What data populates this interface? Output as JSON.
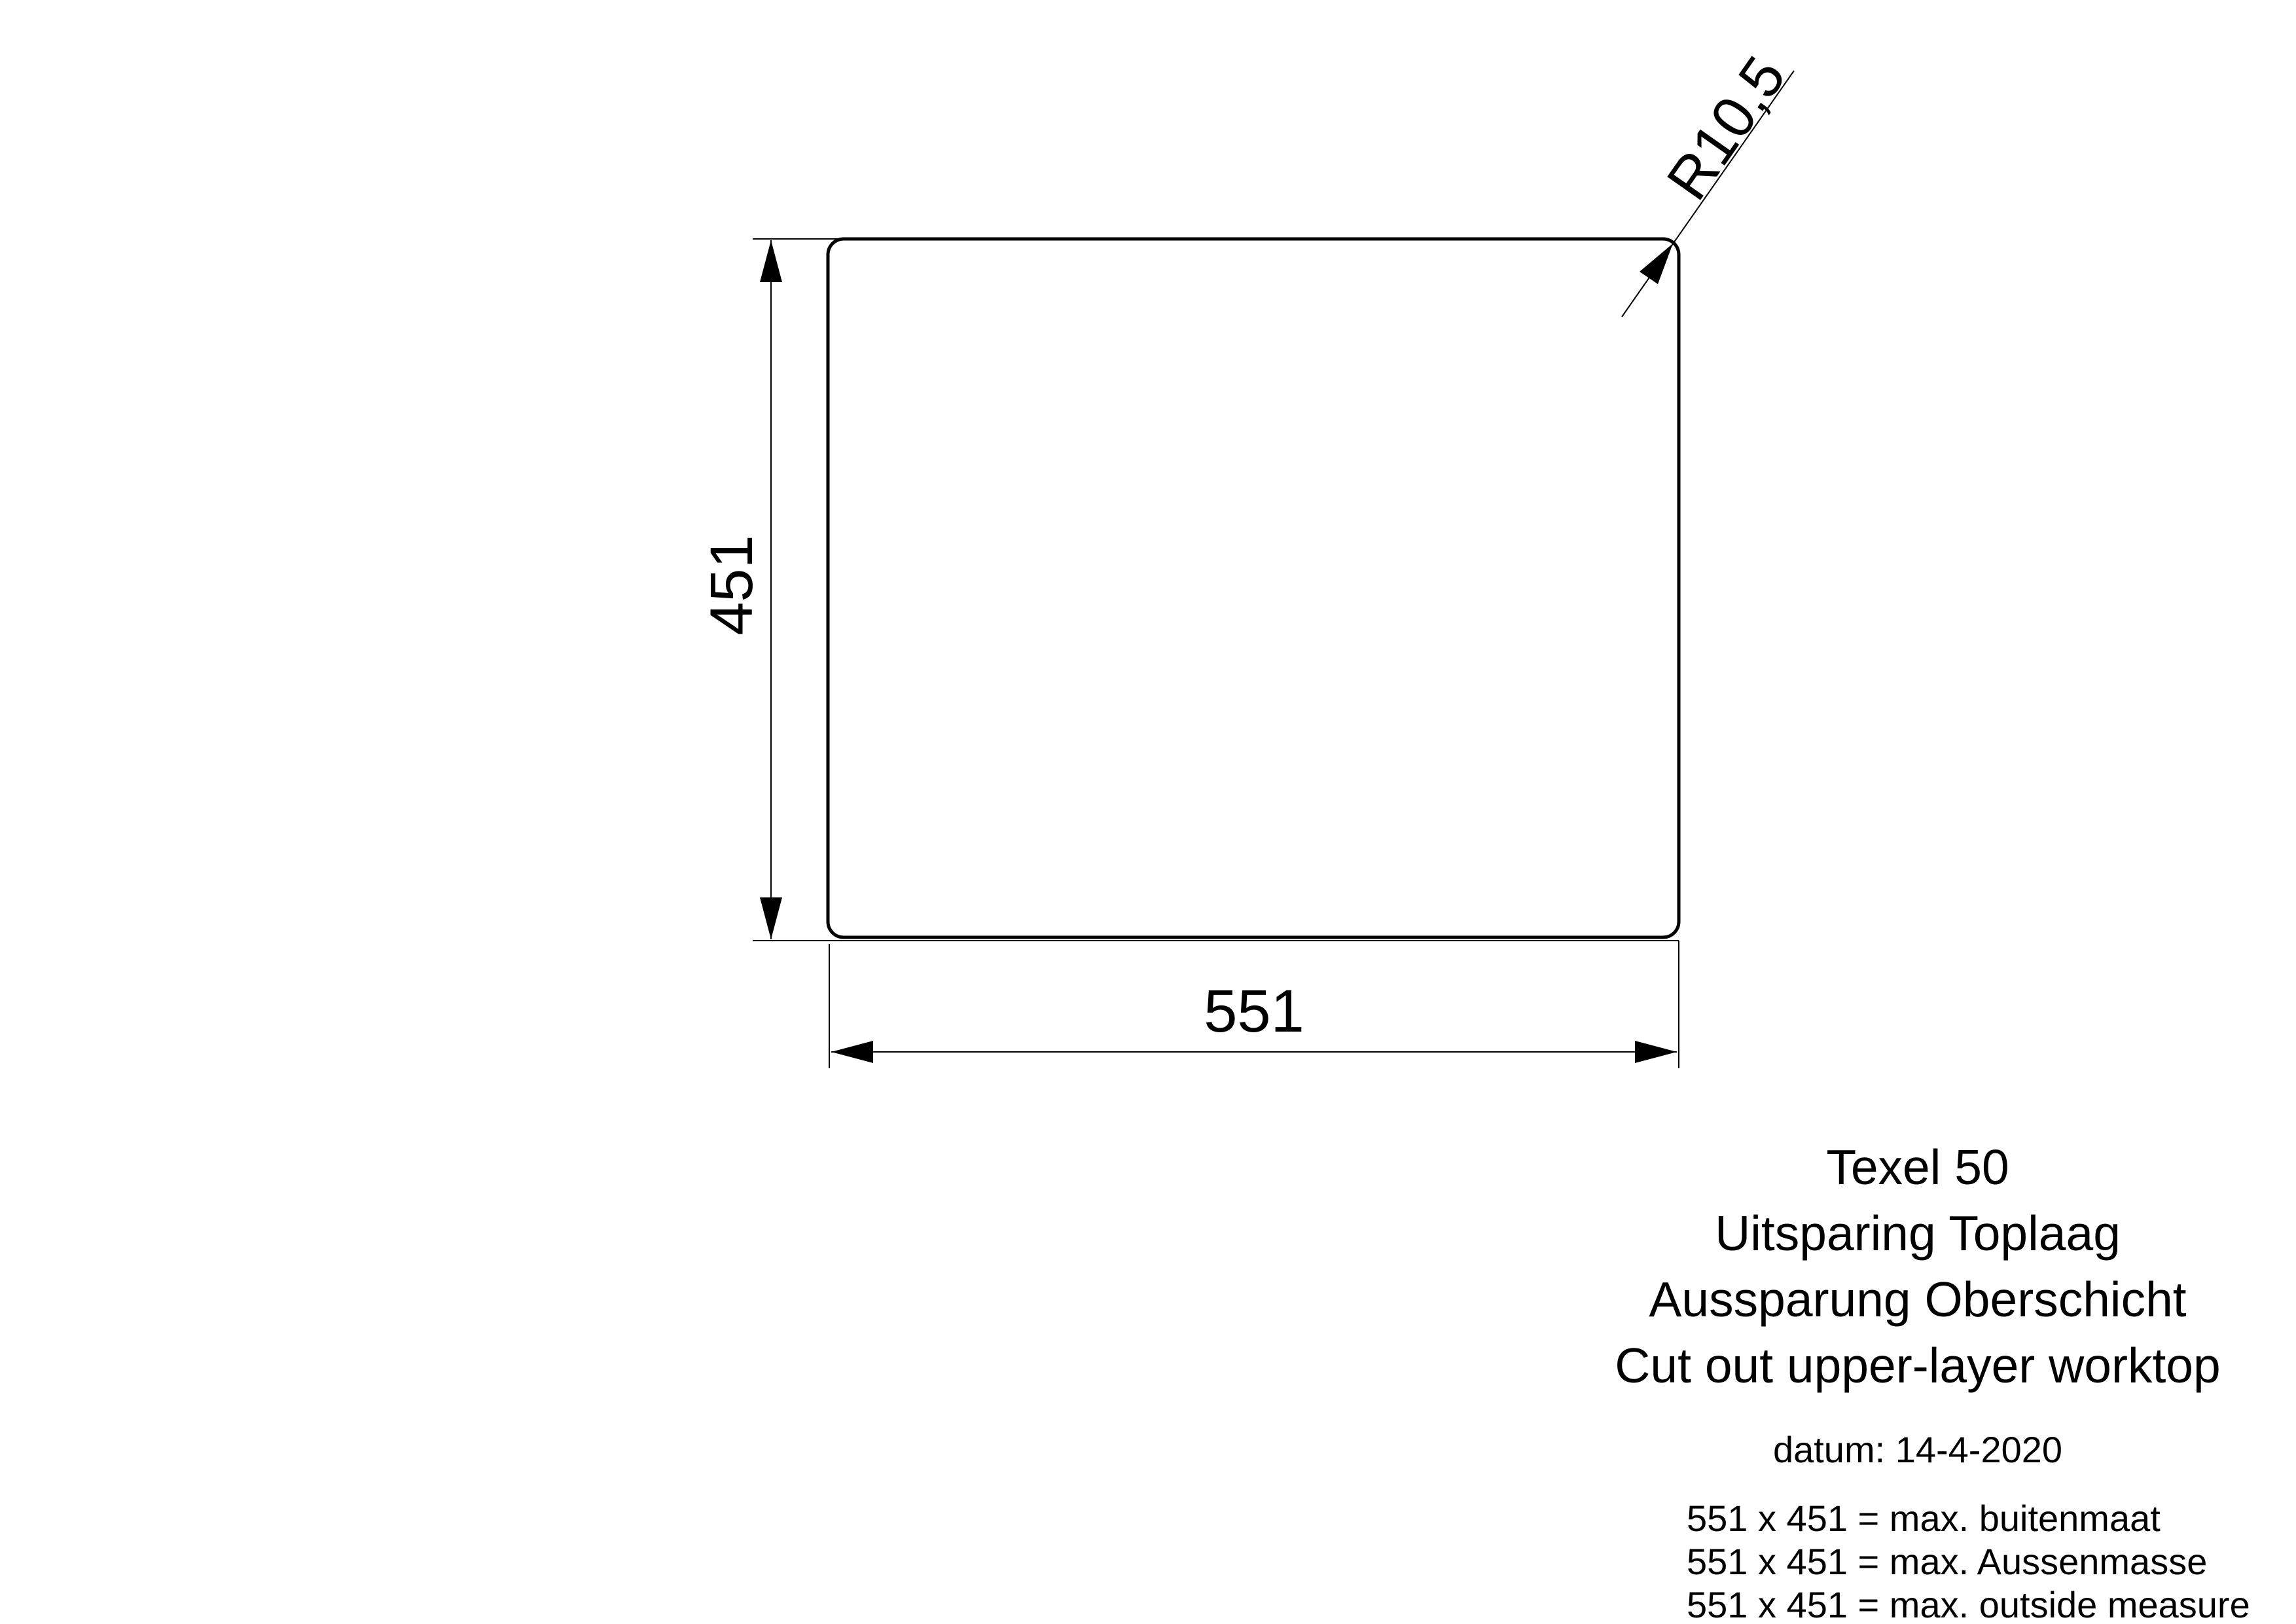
{
  "drawing": {
    "width_label": "551",
    "height_label": "451",
    "radius_label": "R10,5",
    "width_mm": 551,
    "height_mm": 451,
    "corner_radius_mm": 10.5
  },
  "title_block": {
    "lines": [
      "Texel 50",
      "Uitsparing Toplaag",
      "Aussparung Oberschicht",
      "Cut out upper-layer worktop"
    ],
    "date_line": "datum: 14-4-2020",
    "measure_lines": [
      "551 x 451 = max. buitenmaat",
      "551 x 451 = max. Aussenmasse",
      "551 x 451 = max. outside measure"
    ]
  },
  "colors": {
    "ink": "#000000",
    "background": "#ffffff"
  }
}
